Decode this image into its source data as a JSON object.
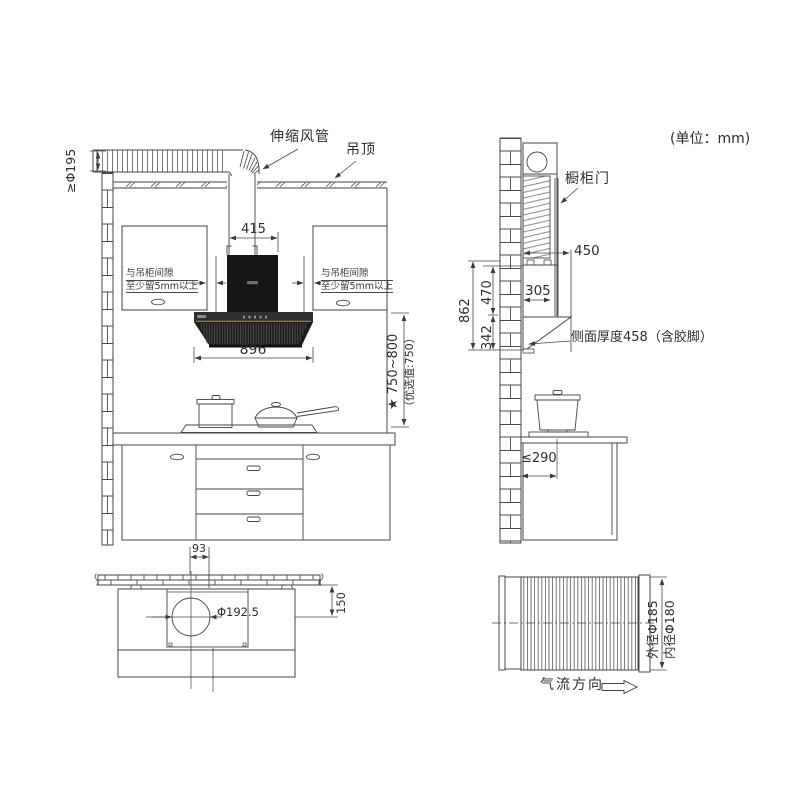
{
  "unit_note": "(单位：mm)",
  "front_view": {
    "duct_label": "伸缩风管",
    "ceiling_label": "吊顶",
    "duct_dia_note": "≥Φ195",
    "dim_duct_width": "415",
    "gap_note_line1": "与吊柜间隙",
    "gap_note_line2": "至少留5mm以上",
    "dim_hood_width": "896",
    "dim_install_height": "★ 750~800",
    "dim_install_height_pref": "（优选值:750）"
  },
  "side_view": {
    "cabinet_door_label": "橱柜门",
    "dim_depth": "450",
    "dim_total_height": "862",
    "dim_upper_height": "470",
    "dim_lower_height": "342",
    "dim_chimney_depth": "305",
    "thickness_note": "侧面厚度458（含胶脚）",
    "dim_stove_distance": "≤290"
  },
  "top_view": {
    "dim_offset": "93",
    "dim_hole_dia": "Φ192.5",
    "dim_wall_distance": "150"
  },
  "duct_section": {
    "outer_dia_label": "外径Φ185",
    "inner_dia_label": "内径Φ180",
    "airflow_label": "气流方向"
  }
}
